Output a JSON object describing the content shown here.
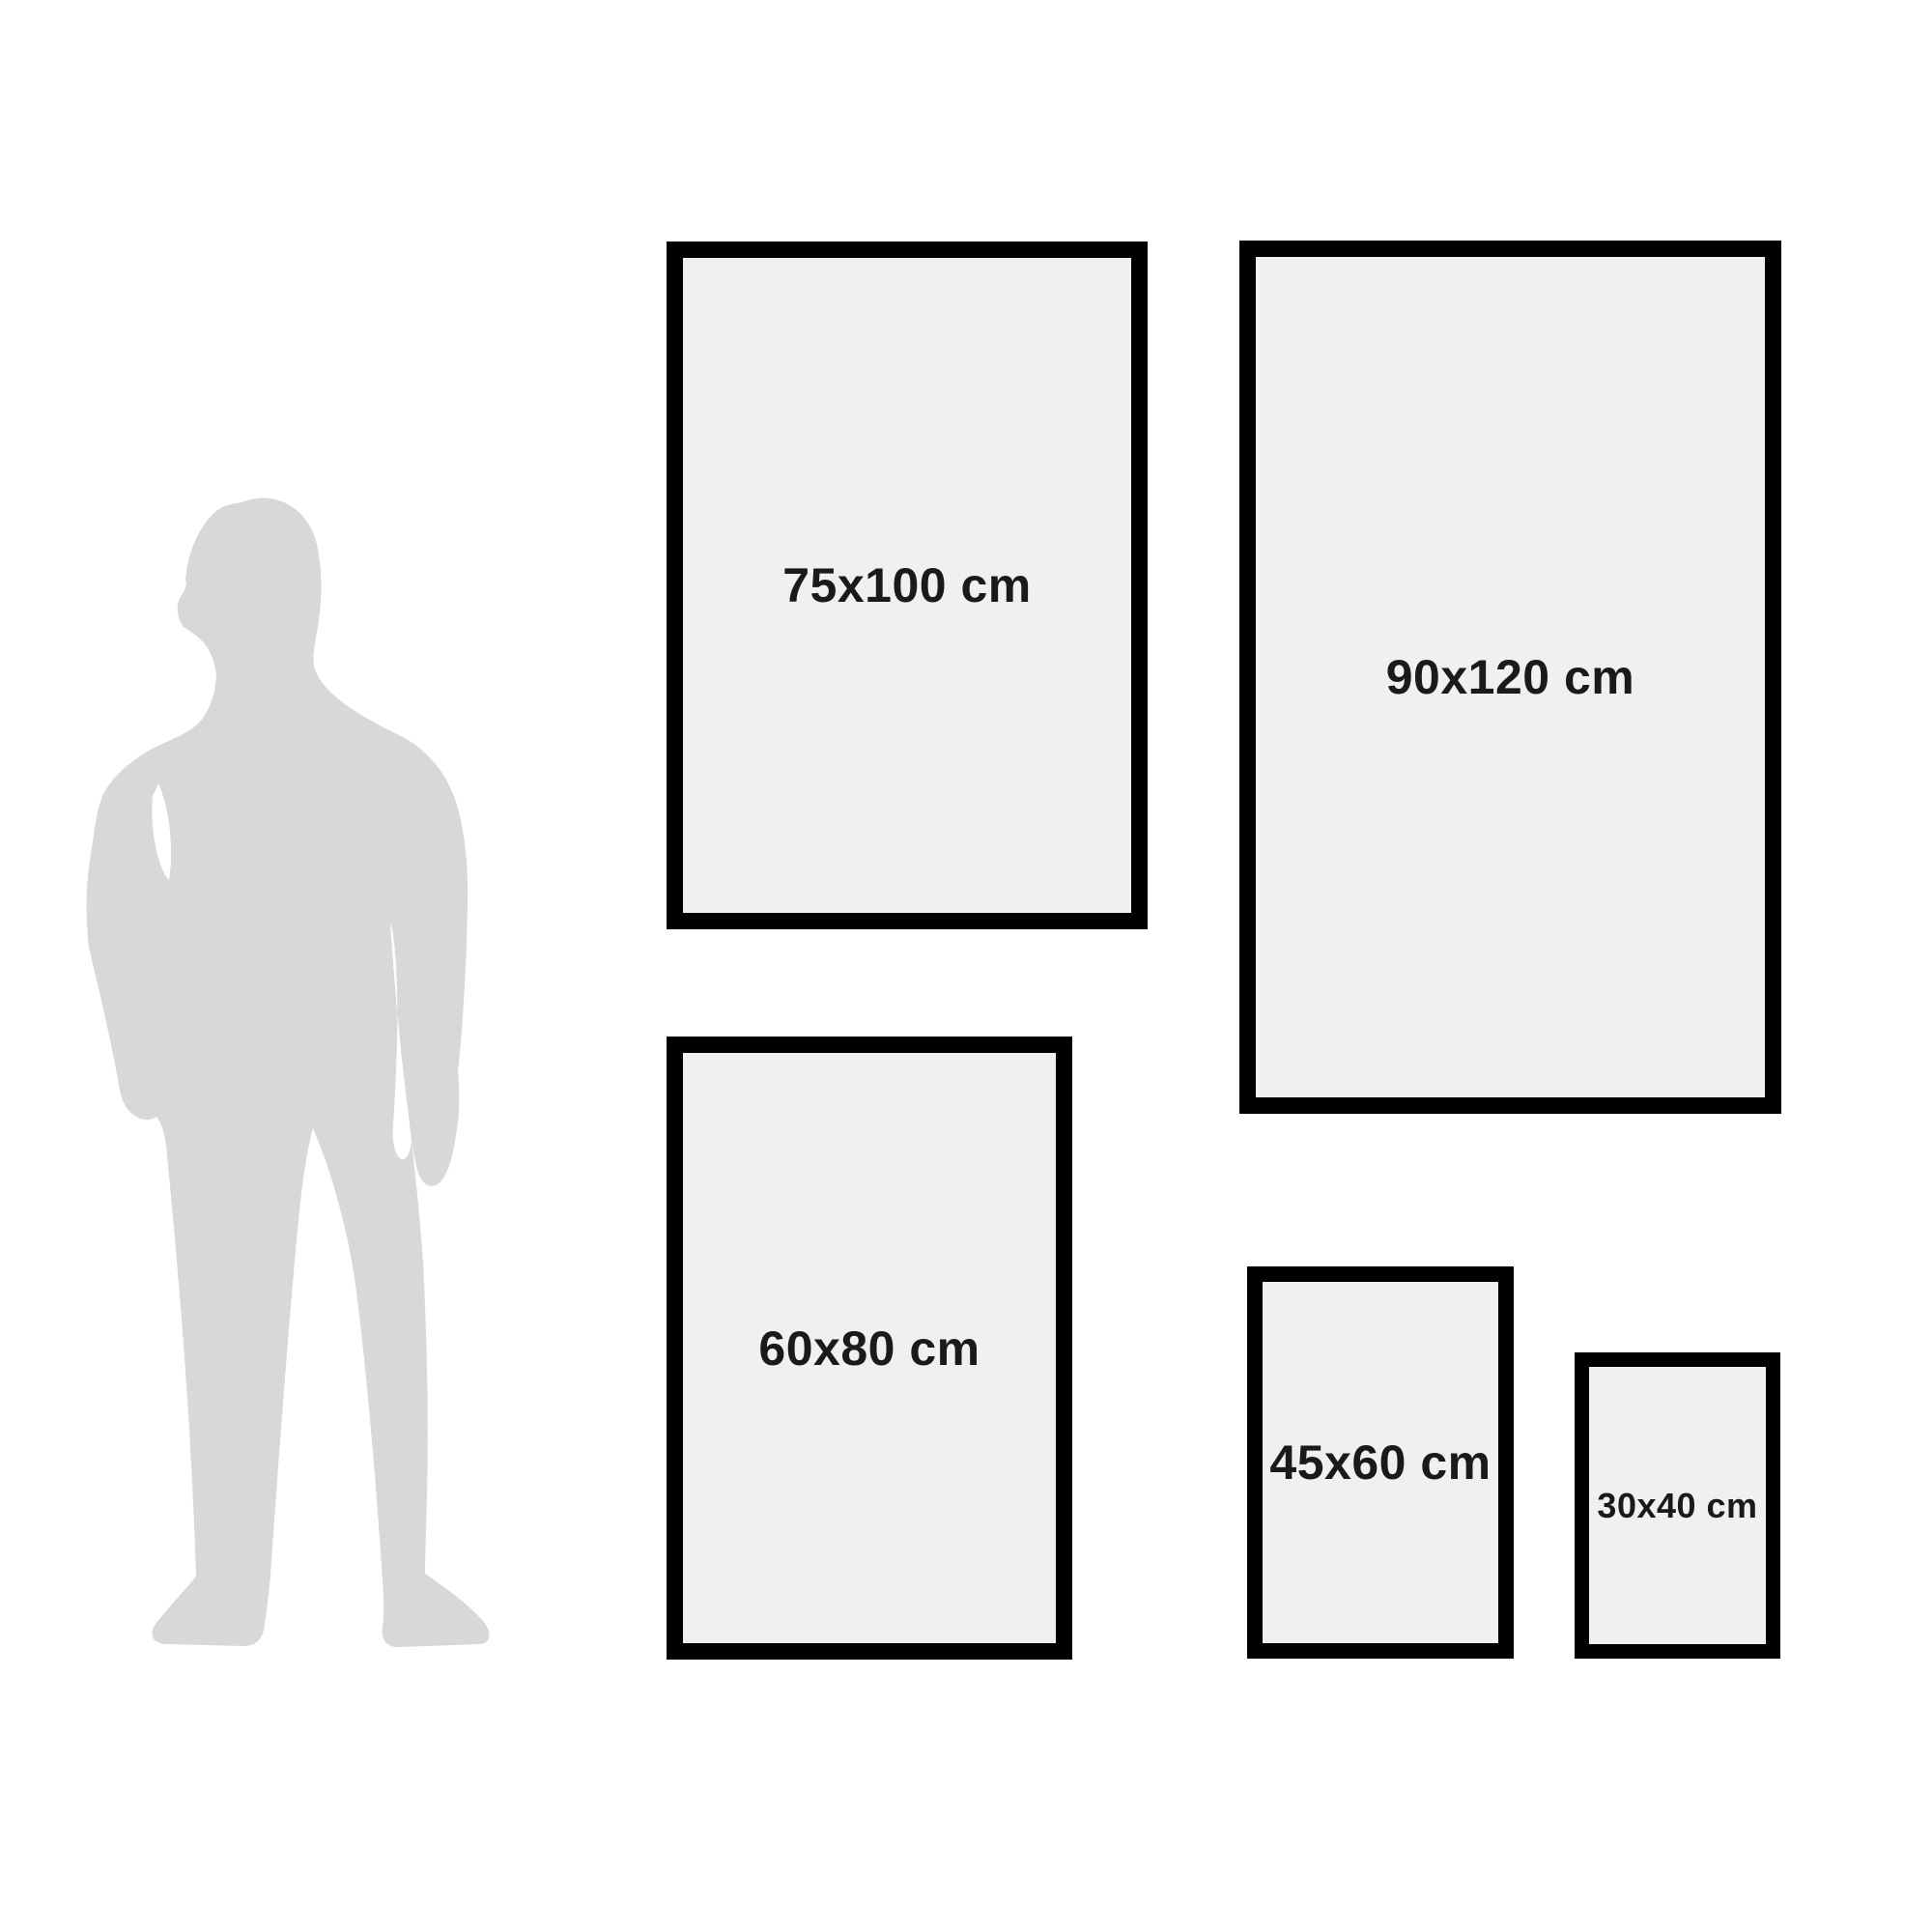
{
  "frames": [
    {
      "id": "75x100",
      "label": "75x100 cm"
    },
    {
      "id": "90x120",
      "label": "90x120 cm"
    },
    {
      "id": "60x80",
      "label": "60x80 cm"
    },
    {
      "id": "45x60",
      "label": "45x60 cm"
    },
    {
      "id": "30x40",
      "label": "30x40 cm"
    }
  ],
  "icons": [
    {
      "name": "person-silhouette",
      "shape": "standing man in suit, grey fill, shown for scale"
    }
  ],
  "colors": {
    "background": "#ffffff",
    "frame_border": "#000000",
    "frame_fill": "#f0f0f0",
    "silhouette": "#d8d8da",
    "text": "#1a1a1a"
  }
}
